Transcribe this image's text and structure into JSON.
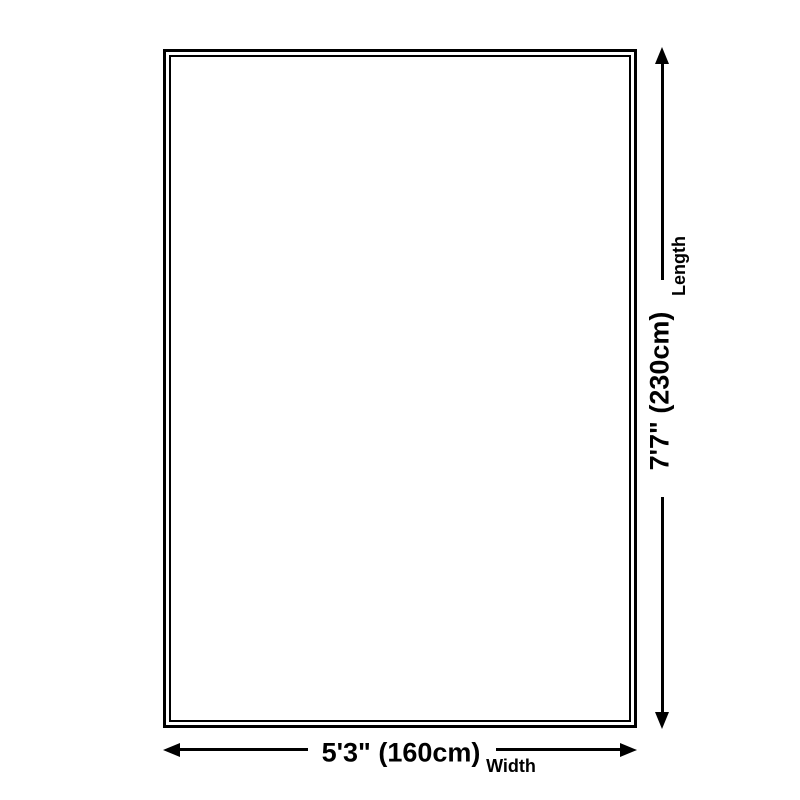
{
  "diagram": {
    "kind": "product-size-diagram",
    "background_color": "#ffffff",
    "line_color": "#000000",
    "dimensions": {
      "length": {
        "value": "7'7\" (230cm)",
        "label": "Length"
      },
      "width": {
        "value": "5'3\" (160cm)",
        "label": "Width"
      }
    }
  }
}
